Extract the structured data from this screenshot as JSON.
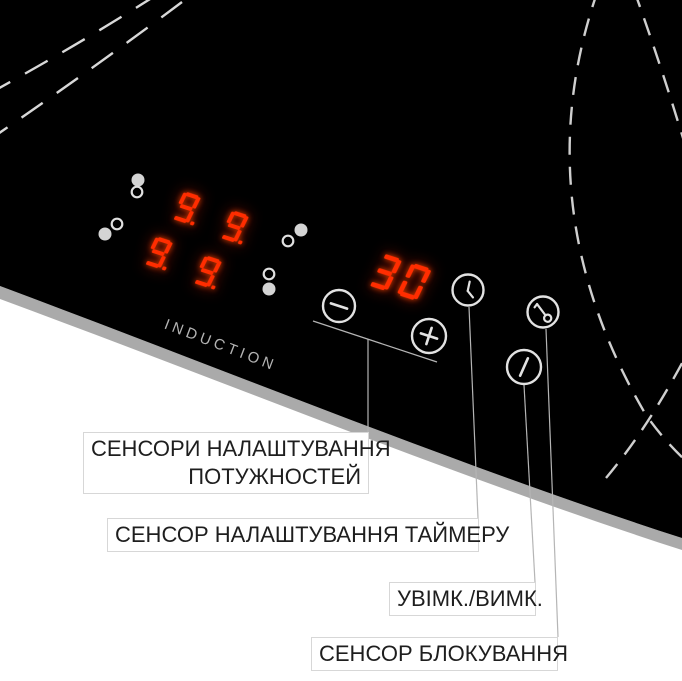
{
  "device": {
    "brand_text": "INDUCTION",
    "power_displays": {
      "values": [
        "9.",
        "9.",
        "9.",
        "9."
      ]
    },
    "timer_display": {
      "value": "30"
    }
  },
  "buttons": {
    "minus": {
      "icon": "minus-icon"
    },
    "plus": {
      "icon": "plus-icon"
    },
    "timer": {
      "icon": "clock-icon"
    },
    "lock": {
      "icon": "key-icon"
    },
    "power": {
      "icon": "power-slash-icon"
    }
  },
  "callouts": [
    {
      "id": "power-sensors",
      "lines": [
        "СЕНСОРИ НАЛАШТУВАННЯ",
        "ПОТУЖНОСТЕЙ"
      ]
    },
    {
      "id": "timer-sensor",
      "lines": [
        "СЕНСОР НАЛАШТУВАННЯ ТАЙМЕРУ"
      ]
    },
    {
      "id": "on-off",
      "lines": [
        "УВІМК./ВИМК."
      ]
    },
    {
      "id": "lock-sensor",
      "lines": [
        "СЕНСОР БЛОКУВАННЯ"
      ]
    }
  ],
  "colors": {
    "display_red": "#ff2d00",
    "glass_black": "#000000",
    "bevel_gray": "#aaaaaa",
    "icon_stroke": "#e2e2e2",
    "leader_gray": "#b5b5b5",
    "label_text": "#1e1e1e"
  }
}
